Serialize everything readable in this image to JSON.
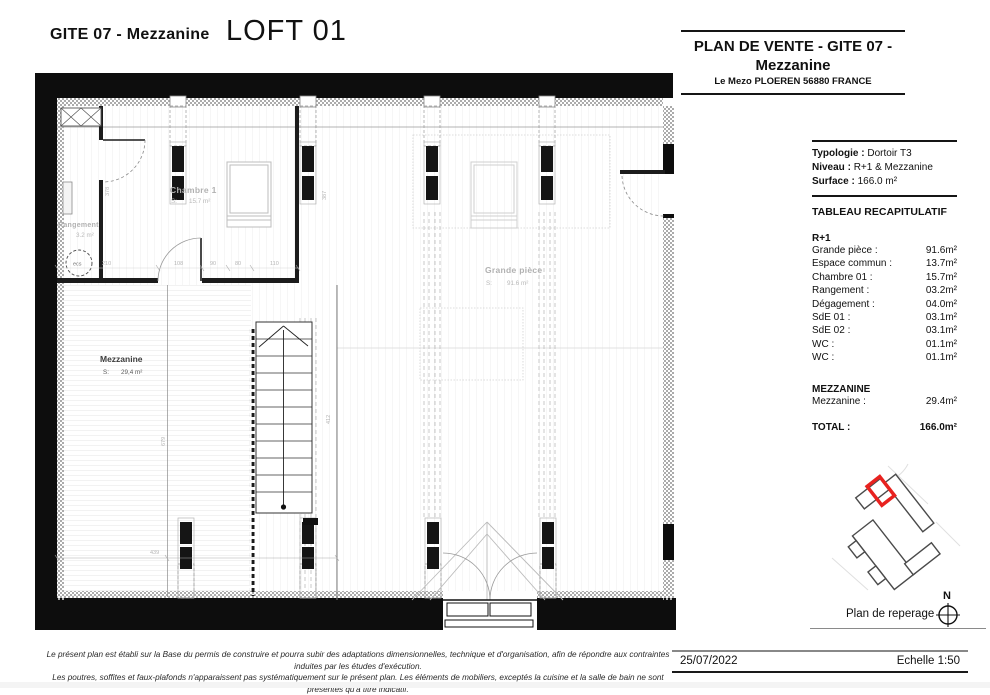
{
  "header": {
    "project_ref": "GITE 07 - Mezzanine",
    "unit_title": "LOFT 01"
  },
  "title_block": {
    "title_line1": "PLAN DE VENTE - GITE 07 -",
    "title_line2": "Mezzanine",
    "address": "Le Mezo PLOEREN 56880 FRANCE",
    "typology_label": "Typologie :",
    "typology_value": "Dortoir T3",
    "level_label": "Niveau :",
    "level_value": "R+1 & Mezzanine",
    "surface_label": "Surface :",
    "surface_value": "166.0 m²"
  },
  "summary": {
    "title": "TABLEAU RECAPITULATIF",
    "section1_name": "R+1",
    "rows": [
      {
        "label": "Grande pièce :",
        "value": "91.6m²"
      },
      {
        "label": "Espace commun :",
        "value": "13.7m²"
      },
      {
        "label": "Chambre 01 :",
        "value": "15.7m²"
      },
      {
        "label": "Rangement :",
        "value": "03.2m²"
      },
      {
        "label": "Dégagement :",
        "value": "04.0m²"
      },
      {
        "label": "SdE 01 :",
        "value": "03.1m²"
      },
      {
        "label": "SdE 02 :",
        "value": "03.1m²"
      },
      {
        "label": "WC :",
        "value": "01.1m²"
      },
      {
        "label": "WC :",
        "value": "01.1m²"
      }
    ],
    "section2_name": "MEZZANINE",
    "rows2": [
      {
        "label": "Mezzanine :",
        "value": "29.4m²"
      }
    ],
    "total_label": "TOTAL :",
    "total_value": "166.0m²"
  },
  "locator": {
    "caption": "Plan de reperage",
    "north_label": "N",
    "highlight_color": "#e8221f"
  },
  "footer": {
    "disclaimer_line1": "Le présent plan est établi sur la Base du permis de construire et pourra subir des adaptations dimensionnelles, technique et d'organisation, afin de répondre aux contraintes induites par les études d'exécution.",
    "disclaimer_line2": "Les poutres, soffites et faux-plafonds n'apparaissent pas systématiquement sur le présent plan. Les éléments de mobiliers, exceptés la cuisine et la salle de bain ne sont présentés qu'à titre indicatif.",
    "date": "25/07/2022",
    "scale": "Echelle 1:50"
  },
  "plan": {
    "s_label": "S:",
    "rooms": {
      "chambre": {
        "name": "Chambre 1",
        "area": "15.7 m²"
      },
      "rangement": {
        "name": "Rangement",
        "area": "3.2 m²"
      },
      "grande": {
        "name": "Grande pièce",
        "area": "91.6 m²"
      },
      "mezzanine": {
        "name": "Mezzanine",
        "area": "29,4 m²"
      }
    },
    "equipment": {
      "ecs": "ecs"
    },
    "dimensions": [
      {
        "text": "210",
        "x": 102,
        "y": 265
      },
      {
        "text": "108",
        "x": 174,
        "y": 265
      },
      {
        "text": "90",
        "x": 210,
        "y": 265
      },
      {
        "text": "80",
        "x": 235,
        "y": 265
      },
      {
        "text": "110",
        "x": 270,
        "y": 265
      },
      {
        "text": "378",
        "x": 109,
        "y": 196,
        "rot": -90
      },
      {
        "text": "387",
        "x": 326,
        "y": 200,
        "rot": -90
      },
      {
        "text": "412",
        "x": 330,
        "y": 424,
        "rot": -90
      },
      {
        "text": "679",
        "x": 165,
        "y": 446,
        "rot": -90
      },
      {
        "text": "439",
        "x": 150,
        "y": 554
      }
    ]
  }
}
